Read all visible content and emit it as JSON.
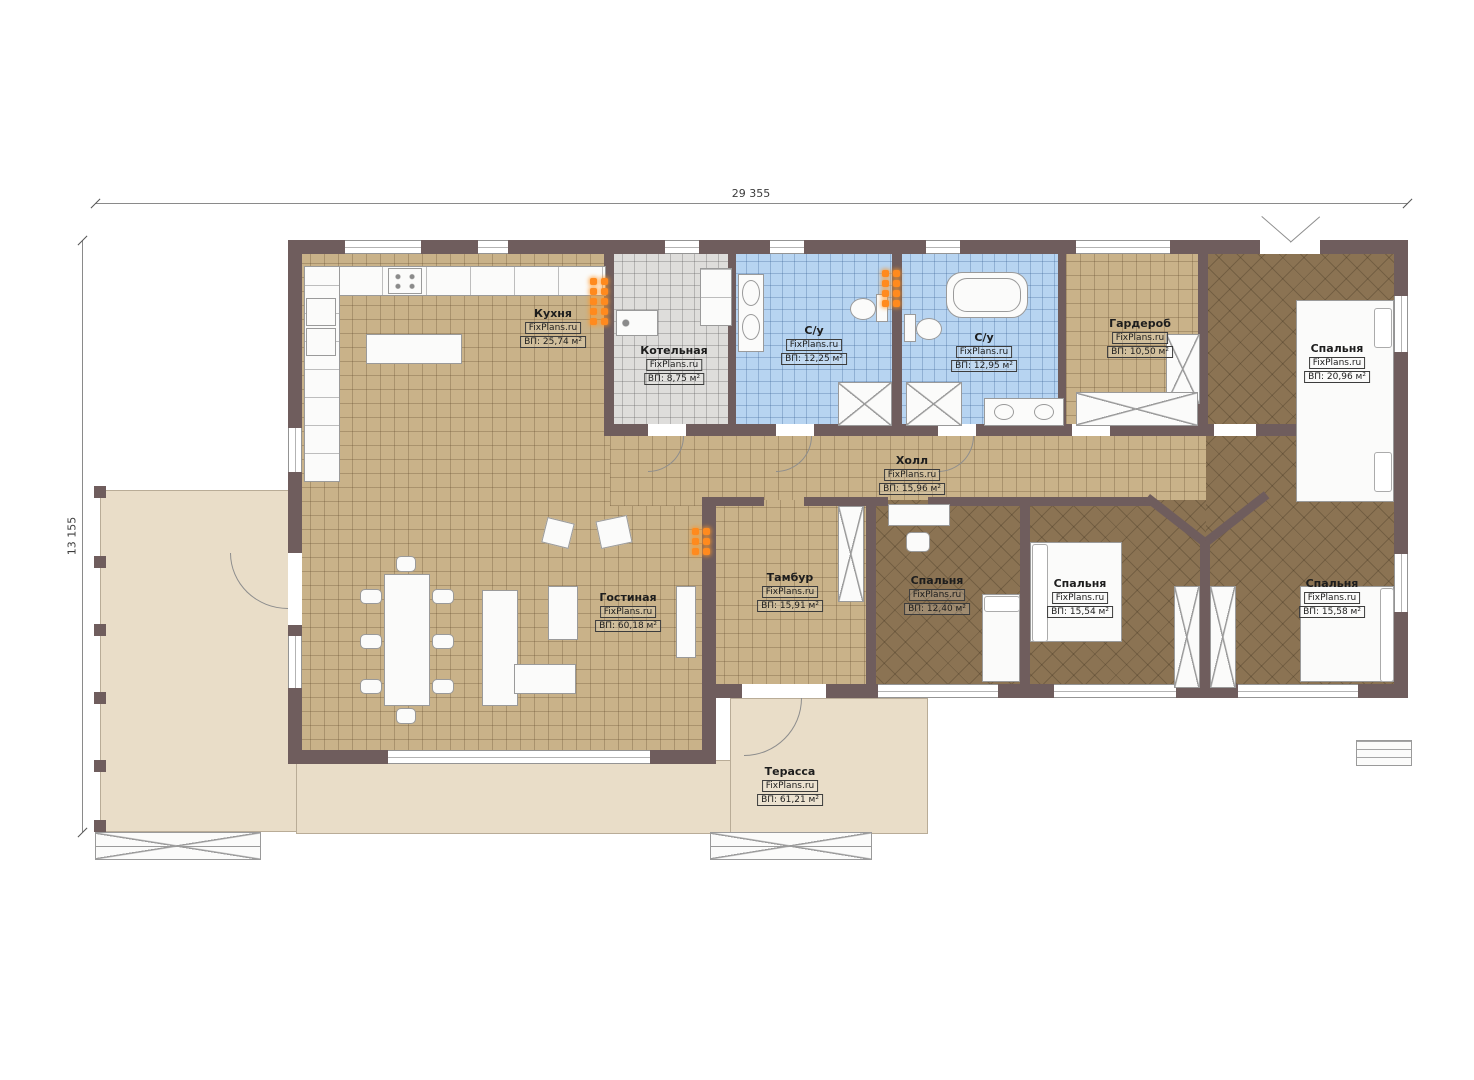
{
  "plan": {
    "source_watermark": "FixPlans.ru",
    "dimensions": {
      "width_label": "29 355",
      "height_label": "13 155"
    },
    "colors": {
      "wall": "#6f5d5d",
      "tile_floor": "#c9b289",
      "bathroom_floor": "#b7d4f1",
      "boiler_floor": "#dedddb",
      "bedroom_floor": "#8b7353",
      "terrace_floor": "#e9ddc8",
      "radiator": "#ff8a1e"
    },
    "rooms": {
      "kitchen": {
        "name": "Кухня",
        "wm": "FixPlans.ru",
        "area": "ВП: 25,74 м²"
      },
      "boiler": {
        "name": "Котельная",
        "wm": "FixPlans.ru",
        "area": "ВП: 8,75 м²"
      },
      "bath1": {
        "name": "С/у",
        "wm": "FixPlans.ru",
        "area": "ВП: 12,25 м²"
      },
      "bath2": {
        "name": "С/у",
        "wm": "FixPlans.ru",
        "area": "ВП: 12,95 м²"
      },
      "wardrobe": {
        "name": "Гардероб",
        "wm": "FixPlans.ru",
        "area": "ВП: 10,50 м²"
      },
      "bedroom_tr": {
        "name": "Спальня",
        "wm": "FixPlans.ru",
        "area": "ВП: 20,96 м²"
      },
      "hall": {
        "name": "Холл",
        "wm": "FixPlans.ru",
        "area": "ВП: 15,96 м²"
      },
      "tambur": {
        "name": "Тамбур",
        "wm": "FixPlans.ru",
        "area": "ВП: 15,91 м²"
      },
      "bedroom_mid": {
        "name": "Спальня",
        "wm": "FixPlans.ru",
        "area": "ВП: 12,40 м²"
      },
      "bedroom_center": {
        "name": "Спальня",
        "wm": "FixPlans.ru",
        "area": "ВП: 15,54 м²"
      },
      "bedroom_br": {
        "name": "Спальня",
        "wm": "FixPlans.ru",
        "area": "ВП: 15,58 м²"
      },
      "living": {
        "name": "Гостиная",
        "wm": "FixPlans.ru",
        "area": "ВП: 60,18 м²"
      },
      "terrace": {
        "name": "Терасса",
        "wm": "FixPlans.ru",
        "area": "ВП: 61,21 м²"
      }
    }
  }
}
